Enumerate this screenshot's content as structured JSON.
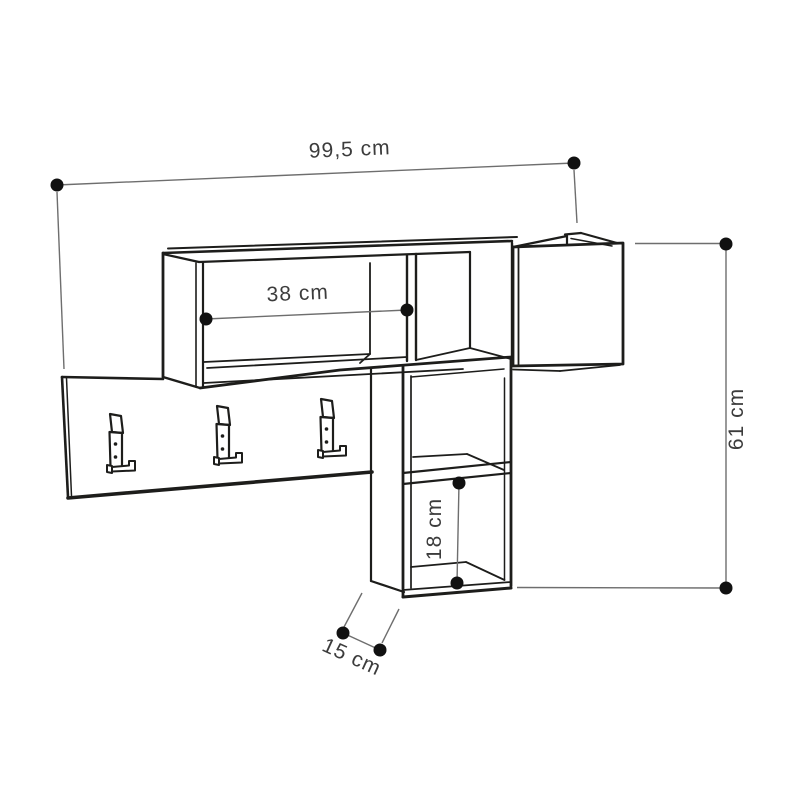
{
  "diagram": {
    "kind": "wall-mounted coat rack shelf dimension drawing",
    "labels": {
      "width": "99,5 cm",
      "shelf_width": "38 cm",
      "height": "61 cm",
      "inner_height": "18 cm",
      "depth": "15 cm"
    },
    "colors": {
      "background": "#ffffff",
      "line": "#1d1d1b",
      "dimension_line": "#6e6e6e",
      "marker": "#111111",
      "text": "#3c3c3c"
    }
  }
}
